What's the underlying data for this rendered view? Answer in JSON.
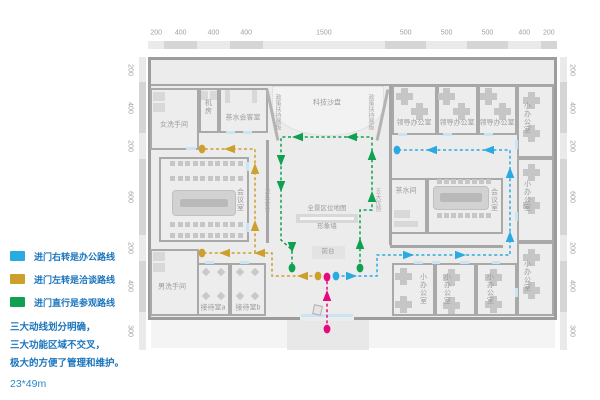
{
  "colors": {
    "office_route": "#29ABE2",
    "negotiation_route": "#CDA02E",
    "visit_route": "#0FA050",
    "entry_route": "#E5097F",
    "legend_text": "#1B75BC"
  },
  "plan": {
    "x": 148,
    "y": 57,
    "w": 409,
    "h": 263
  },
  "rulers": {
    "top": [
      "200",
      "400",
      "400",
      "400",
      "1500",
      "500",
      "500",
      "500",
      "400",
      "200"
    ],
    "left": [
      "200",
      "400",
      "200",
      "600",
      "200",
      "400",
      "300"
    ],
    "right": [
      "200",
      "400",
      "200",
      "600",
      "200",
      "400",
      "300"
    ]
  },
  "rooms": [
    {
      "name": "room-women-restroom",
      "label": "女洗手间",
      "x": 150,
      "y": 88,
      "w": 49,
      "h": 62,
      "lx": 174,
      "ly": 125,
      "vert": false
    },
    {
      "name": "room-machine",
      "label": "机房",
      "x": 199,
      "y": 88,
      "w": 20,
      "h": 45,
      "lx": 208,
      "ly": 107,
      "vert": true
    },
    {
      "name": "room-tea-meeting",
      "label": "茶水会客室",
      "x": 219,
      "y": 88,
      "w": 49,
      "h": 45,
      "lx": 243,
      "ly": 118,
      "vert": false
    },
    {
      "name": "room-leader-office-1",
      "label": "领导办公室",
      "x": 392,
      "y": 85,
      "w": 45,
      "h": 50,
      "lx": 414,
      "ly": 123,
      "vert": false
    },
    {
      "name": "room-leader-office-2",
      "label": "领导办公室",
      "x": 437,
      "y": 85,
      "w": 41,
      "h": 50,
      "lx": 457,
      "ly": 123,
      "vert": false
    },
    {
      "name": "room-leader-office-3",
      "label": "领导办公室",
      "x": 478,
      "y": 85,
      "w": 39,
      "h": 50,
      "lx": 497,
      "ly": 123,
      "vert": false
    },
    {
      "name": "room-small-office-r1",
      "label": "小办公室",
      "x": 517,
      "y": 85,
      "w": 37,
      "h": 73,
      "lx": 527,
      "ly": 118,
      "vert": true
    },
    {
      "name": "room-small-office-r2",
      "label": "小办公室",
      "x": 517,
      "y": 158,
      "w": 37,
      "h": 84,
      "lx": 527,
      "ly": 196,
      "vert": true
    },
    {
      "name": "room-small-office-r3",
      "label": "小办公室",
      "x": 517,
      "y": 242,
      "w": 37,
      "h": 74,
      "lx": 527,
      "ly": 276,
      "vert": true
    },
    {
      "name": "room-conference-left",
      "label": "会议室",
      "x": 159,
      "y": 157,
      "w": 90,
      "h": 85,
      "lx": 240,
      "ly": 200,
      "vert": true
    },
    {
      "name": "room-men-restroom",
      "label": "男洗手间",
      "x": 150,
      "y": 249,
      "w": 49,
      "h": 67,
      "lx": 172,
      "ly": 287,
      "vert": false
    },
    {
      "name": "room-reception-a",
      "label": "接待室a",
      "x": 197,
      "y": 263,
      "w": 33,
      "h": 53,
      "lx": 213,
      "ly": 308,
      "vert": false
    },
    {
      "name": "room-reception-b",
      "label": "接待室b",
      "x": 230,
      "y": 263,
      "w": 36,
      "h": 53,
      "lx": 248,
      "ly": 308,
      "vert": false
    },
    {
      "name": "room-pantry",
      "label": "茶水间",
      "x": 390,
      "y": 178,
      "w": 37,
      "h": 56,
      "lx": 406,
      "ly": 191,
      "vert": false
    },
    {
      "name": "room-conference-right",
      "label": "会议室",
      "x": 427,
      "y": 178,
      "w": 76,
      "h": 56,
      "lx": 494,
      "ly": 200,
      "vert": true
    },
    {
      "name": "room-small-office-b1",
      "label": "小办公室",
      "x": 392,
      "y": 263,
      "w": 43,
      "h": 53,
      "lx": 423,
      "ly": 289,
      "vert": true
    },
    {
      "name": "room-small-office-b2",
      "label": "小办公室",
      "x": 435,
      "y": 263,
      "w": 41,
      "h": 53,
      "lx": 447,
      "ly": 289,
      "vert": true
    },
    {
      "name": "room-small-office-b3",
      "label": "小办公室",
      "x": 476,
      "y": 263,
      "w": 41,
      "h": 53,
      "lx": 490,
      "ly": 289,
      "vert": true
    }
  ],
  "stage": {
    "name": "tech-sandtable",
    "label": "科技沙盘",
    "x": 272,
    "y": 86,
    "w": 112,
    "h": 50,
    "lx": 327,
    "ly": 103
  },
  "features": [
    {
      "name": "panorama-map-label",
      "text": "全景区位地图",
      "x": 327,
      "y": 209,
      "fs": 6.5
    },
    {
      "name": "image-wall-label",
      "text": "形象墙",
      "x": 327,
      "y": 227,
      "fs": 6.5
    },
    {
      "name": "front-desk-label",
      "text": "前台",
      "x": 328,
      "y": 252,
      "fs": 6.5
    }
  ],
  "wall_labels": [
    {
      "name": "policy-panel-left-label",
      "text": "政策扶持展板",
      "x": 277,
      "y": 112
    },
    {
      "name": "policy-panel-right-label",
      "text": "政策扶持展板",
      "x": 370,
      "y": 112
    },
    {
      "name": "leading-enterprise-label",
      "text": "龙头企业",
      "x": 266,
      "y": 200
    },
    {
      "name": "five-advantages-label",
      "text": "五大优势",
      "x": 377,
      "y": 200
    }
  ],
  "walls": [
    [
      150,
      84,
      405,
      2
    ],
    [
      266,
      140,
      3,
      103
    ],
    [
      389,
      85,
      3,
      160
    ],
    [
      390,
      245,
      113,
      3
    ]
  ],
  "angled_walls": [
    {
      "x": 271,
      "y": 89,
      "h": 52,
      "rot": -12
    },
    {
      "x": 381,
      "y": 89,
      "h": 52,
      "rot": 12
    }
  ],
  "doors": [
    [
      226,
      131,
      9,
      3
    ],
    [
      243,
      131,
      9,
      3
    ],
    [
      186,
      147,
      10,
      3
    ],
    [
      205,
      261,
      9,
      3
    ],
    [
      240,
      261,
      9,
      3
    ],
    [
      246,
      162,
      3,
      9
    ],
    [
      246,
      223,
      3,
      9
    ],
    [
      398,
      133,
      9,
      3
    ],
    [
      443,
      133,
      9,
      3
    ],
    [
      484,
      133,
      9,
      3
    ],
    [
      414,
      261,
      9,
      3
    ],
    [
      432,
      261,
      8,
      3
    ],
    [
      460,
      261,
      9,
      3
    ],
    [
      492,
      261,
      8,
      3
    ],
    [
      515,
      140,
      3,
      9
    ],
    [
      515,
      212,
      3,
      9
    ],
    [
      515,
      288,
      3,
      9
    ]
  ],
  "bars": [
    [
      153,
      92,
      12,
      9
    ],
    [
      153,
      103,
      12,
      9
    ],
    [
      201,
      91,
      7,
      9
    ],
    [
      210,
      91,
      7,
      9
    ],
    [
      225,
      90,
      5,
      13
    ],
    [
      252,
      90,
      5,
      13
    ],
    [
      153,
      252,
      12,
      9
    ],
    [
      153,
      263,
      12,
      9
    ],
    [
      394,
      210,
      16,
      8
    ],
    [
      394,
      221,
      24,
      6
    ],
    [
      296,
      214,
      62,
      9
    ],
    [
      300,
      217,
      54,
      3,
      "#f5f5f5"
    ],
    [
      312,
      246,
      33,
      13,
      "#e3e3e3"
    ]
  ],
  "desks": [
    [
      404,
      96
    ],
    [
      419,
      111
    ],
    [
      446,
      96
    ],
    [
      461,
      111
    ],
    [
      488,
      96
    ],
    [
      502,
      111
    ],
    [
      531,
      100
    ],
    [
      531,
      133
    ],
    [
      531,
      172
    ],
    [
      531,
      205
    ],
    [
      531,
      257
    ],
    [
      531,
      290
    ],
    [
      403,
      276
    ],
    [
      403,
      304
    ],
    [
      451,
      277
    ],
    [
      451,
      305
    ],
    [
      493,
      277
    ],
    [
      493,
      304
    ]
  ],
  "tables": [
    {
      "x": 172,
      "y": 190,
      "w": 64,
      "h": 26,
      "inner": [
        180,
        199,
        48,
        8
      ]
    },
    {
      "x": 433,
      "y": 186,
      "w": 56,
      "h": 24,
      "inner": [
        440,
        193,
        42,
        9
      ]
    }
  ],
  "chair_rows": [
    {
      "x": 170,
      "y": 161,
      "n": 10,
      "dx": 7.5
    },
    {
      "x": 170,
      "y": 176,
      "n": 10,
      "dx": 7.5
    },
    {
      "x": 170,
      "y": 222,
      "n": 10,
      "dx": 7.5
    },
    {
      "x": 170,
      "y": 233,
      "n": 10,
      "dx": 7.5
    },
    {
      "x": 437,
      "y": 179,
      "n": 8,
      "dx": 7
    },
    {
      "x": 437,
      "y": 213,
      "n": 8,
      "dx": 7
    }
  ],
  "diamonds": [
    [
      206,
      272
    ],
    [
      221,
      272
    ],
    [
      206,
      296
    ],
    [
      221,
      296
    ],
    [
      240,
      272
    ],
    [
      255,
      272
    ],
    [
      240,
      296
    ],
    [
      255,
      296
    ]
  ],
  "entrance": {
    "gap": [
      300,
      316,
      54,
      5
    ],
    "door": [
      301,
      314,
      52,
      3
    ],
    "porch": [
      287,
      320,
      82,
      30
    ],
    "apron": [
      151,
      320,
      404,
      28
    ]
  },
  "routes": [
    {
      "name": "office-route",
      "color": "#29ABE2",
      "paths": [
        [
          [
            336,
            276
          ],
          [
            377,
            276
          ],
          [
            377,
            255
          ],
          [
            510,
            255
          ],
          [
            510,
            150
          ],
          [
            397,
            150
          ]
        ]
      ],
      "dots": [
        [
          336,
          276
        ],
        [
          397,
          150
        ]
      ],
      "arrows": [
        [
          351,
          276,
          0
        ],
        [
          408,
          255,
          0
        ],
        [
          460,
          255,
          0
        ],
        [
          510,
          237,
          -90
        ],
        [
          510,
          173,
          -90
        ],
        [
          489,
          150,
          180
        ],
        [
          432,
          150,
          180
        ]
      ]
    },
    {
      "name": "negotiation-route",
      "color": "#CDA02E",
      "paths": [
        [
          [
            318,
            276
          ],
          [
            272,
            276
          ],
          [
            272,
            253
          ],
          [
            202,
            253
          ]
        ],
        [
          [
            255,
            253
          ],
          [
            255,
            149
          ],
          [
            202,
            149
          ]
        ]
      ],
      "dots": [
        [
          318,
          276
        ],
        [
          202,
          253
        ],
        [
          202,
          149
        ]
      ],
      "arrows": [
        [
          303,
          276,
          180
        ],
        [
          260,
          253,
          180
        ],
        [
          225,
          253,
          180
        ],
        [
          255,
          226,
          -90
        ],
        [
          255,
          169,
          -90
        ],
        [
          230,
          149,
          180
        ]
      ]
    },
    {
      "name": "visit-route",
      "color": "#0FA050",
      "paths": [
        [
          [
            360,
            268
          ],
          [
            360,
            210
          ],
          [
            372,
            210
          ],
          [
            372,
            137
          ],
          [
            281,
            137
          ],
          [
            281,
            240
          ],
          [
            292,
            250
          ],
          [
            292,
            268
          ]
        ]
      ],
      "dots": [
        [
          360,
          268
        ],
        [
          292,
          268
        ]
      ],
      "arrows": [
        [
          360,
          244,
          -90
        ],
        [
          372,
          197,
          -90
        ],
        [
          372,
          155,
          -90
        ],
        [
          352,
          137,
          180
        ],
        [
          298,
          137,
          180
        ],
        [
          281,
          160,
          90
        ],
        [
          281,
          186,
          90
        ],
        [
          292,
          247,
          90
        ]
      ]
    },
    {
      "name": "entry-route",
      "color": "#E5097F",
      "paths": [
        [
          [
            327,
            329
          ],
          [
            327,
            277
          ]
        ]
      ],
      "dots": [
        [
          327,
          329
        ],
        [
          327,
          277
        ]
      ],
      "arrows": [
        [
          327,
          296,
          -90
        ]
      ]
    }
  ],
  "legend": {
    "items": [
      {
        "name": "office-route",
        "color": "#29ABE2",
        "label": "进门右转是办公路线"
      },
      {
        "name": "negotiation-route",
        "color": "#CDA02E",
        "label": "进门左转是洽谈路线"
      },
      {
        "name": "visit-route",
        "color": "#0FA050",
        "label": "进门直行是参观路线"
      }
    ],
    "notes": [
      "三大动线划分明确，",
      "三大功能区域不交叉，",
      "极大的方便了管理和维护。"
    ],
    "scale": "23*49m"
  }
}
